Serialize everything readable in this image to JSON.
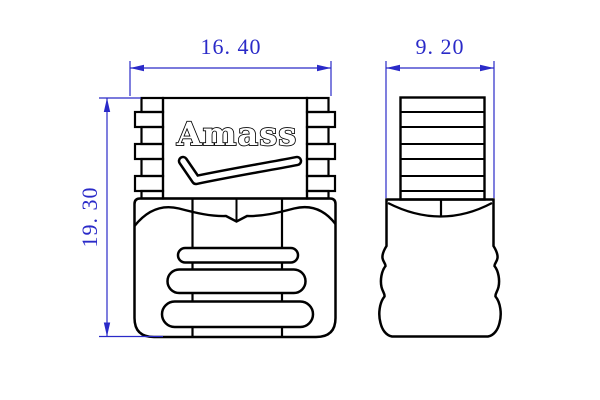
{
  "drawing": {
    "kind": "technical-dimension-drawing",
    "logo": {
      "brand": "Amass",
      "mark": "checkmark-swoosh"
    },
    "dimensions": {
      "front_width": {
        "label": "16. 40",
        "value": 16.4
      },
      "front_height": {
        "label": "19. 30",
        "value": 19.3
      },
      "side_width": {
        "label": "9. 20",
        "value": 9.2
      }
    },
    "colors": {
      "dimension_color": "#2a2ac8",
      "outline_color": "#000000",
      "background": "#ffffff"
    }
  }
}
